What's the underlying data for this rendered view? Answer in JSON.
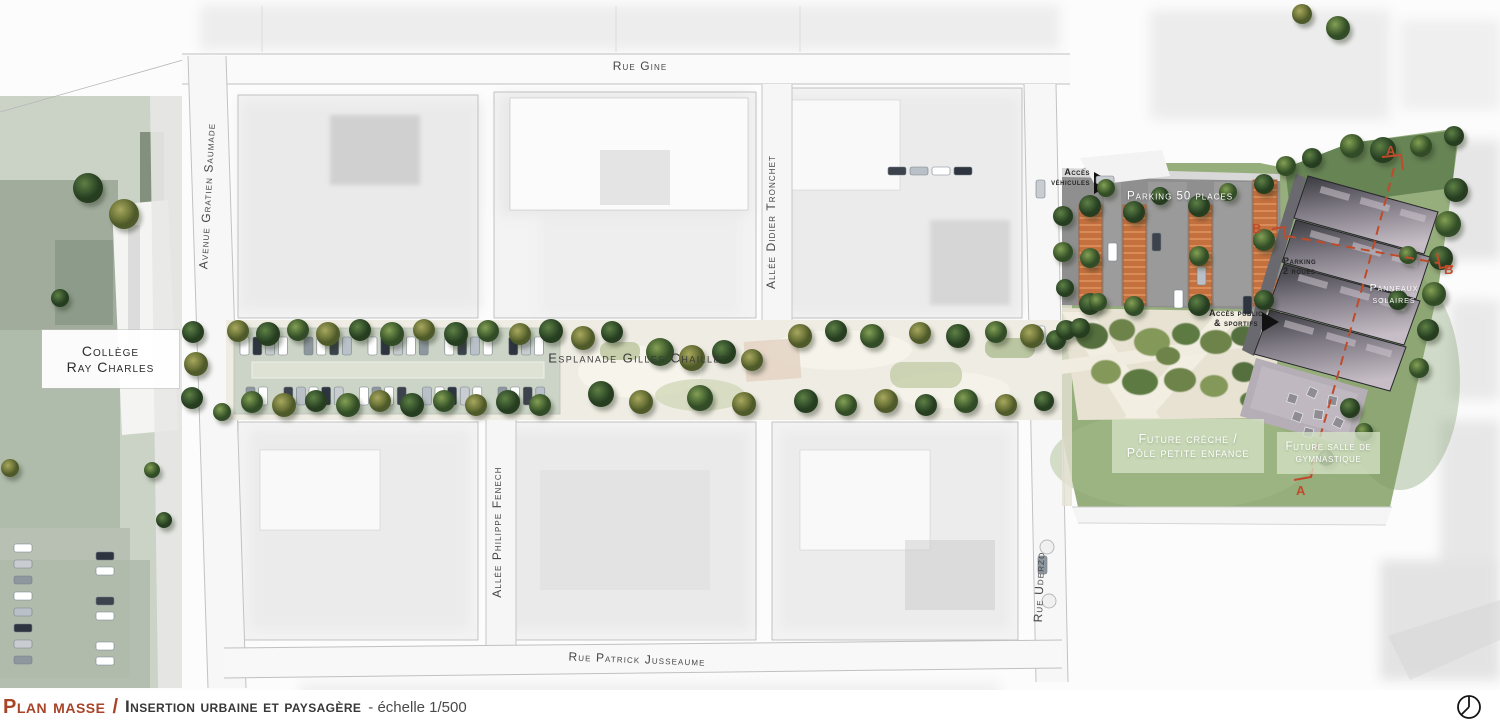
{
  "plan": {
    "streets": {
      "rue_gine": "Rue Gine",
      "avenue_gratien_saumade": "Avenue Gratien Saumade",
      "allee_didier_tronchet": "Allée Didier Tronchet",
      "allee_philippe_fenech": "Allée Philippe Fenech",
      "rue_uderzo": "Rue Uderzo",
      "rue_patrick_jusseaume": "Rue Patrick Jusseaume",
      "esplanade": "Esplanade Gilles Chaillet"
    },
    "landmarks": {
      "college_line1": "Collège",
      "college_line2": "Ray Charles"
    },
    "site": {
      "acces_vehicules_line1": "Accès",
      "acces_vehicules_line2": "véhicules",
      "parking": "Parking 50 places",
      "parking_2roues_line1": "Parking",
      "parking_2roues_line2": "2 roues",
      "acces_public_line1": "Accès public",
      "acces_public_line2": "& sportifs",
      "panneaux_line1": "Panneaux",
      "panneaux_line2": "solaires",
      "creche_line1": "Future crèche /",
      "creche_line2": "Pôle petite enfance",
      "gym_line1": "Future salle de",
      "gym_line2": "gymnastique"
    },
    "sections": {
      "a": "A",
      "b": "B"
    }
  },
  "footer": {
    "title": "Plan masse",
    "separator": "/",
    "subtitle": "Insertion urbaine et paysagère",
    "scale": "- échelle 1/500"
  },
  "colors": {
    "accent_red": "#BF4B2B",
    "grass_green": "#96AD7C",
    "parking_orange": "#C4703F",
    "roof_gray": "#4A474E",
    "label_green_bg": "#D5E3C5",
    "street_text": "#3F3F3F"
  }
}
